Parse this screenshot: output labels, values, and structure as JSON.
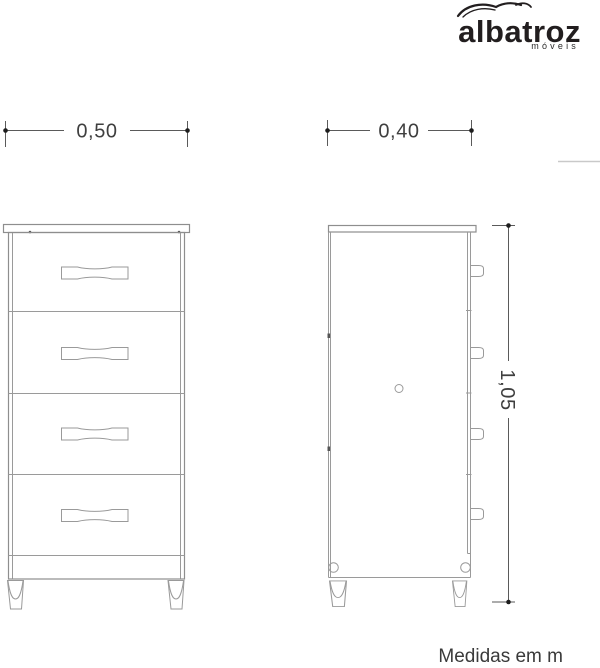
{
  "logo": {
    "brand": "albatroz",
    "tagline": "móveis",
    "bird_icon": "bird-swoosh-icon"
  },
  "dimensions": {
    "front_width": "0,50",
    "side_depth": "0,40",
    "total_height": "1,05"
  },
  "note": {
    "units": "Medidas em m"
  },
  "drawing": {
    "front_view_drawers": 4,
    "views": [
      "front",
      "side"
    ]
  },
  "colors": {
    "furniture_line": "#8e8e8e",
    "dimension_line": "#5a5a5a",
    "text": "#3f3f3f",
    "logo": "#221e1f",
    "background": "#ffffff"
  }
}
